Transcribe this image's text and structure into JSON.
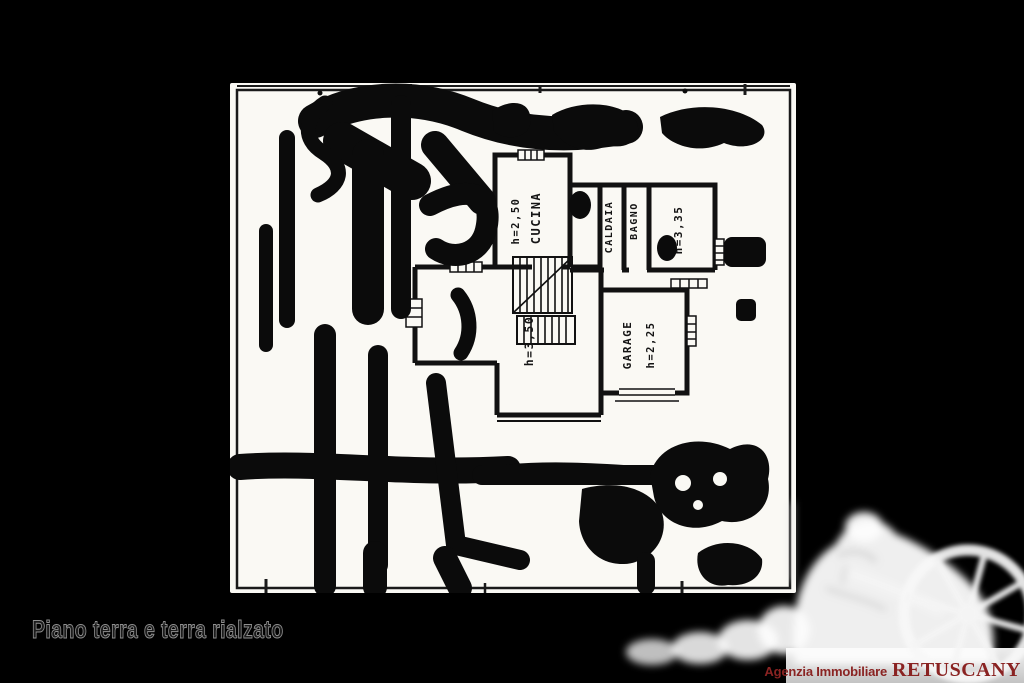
{
  "page": {
    "background": "#000000",
    "width": 1024,
    "height": 683
  },
  "caption": {
    "text": "Piano terra e terra rialzato",
    "color": "#1b1b1b"
  },
  "plan": {
    "colors": {
      "sheet": "#faf9f4",
      "ink": "#0b0b0b"
    },
    "rooms": {
      "cucina": {
        "name": "CUCINA",
        "height": "h=2,50"
      },
      "caldaia": {
        "name": "CALDAIA"
      },
      "bagno": {
        "name": "BAGNO"
      },
      "room_h335": {
        "height": "h=3,35"
      },
      "room_h350": {
        "height": "h=3,50"
      },
      "garage": {
        "name": "GARAGE",
        "height": "h=2,25"
      }
    }
  },
  "agency": {
    "prefix": "Agenzia Immobiliare",
    "brand": "RETUSCANY",
    "text_color": "#8a2322",
    "strip_color": "#d9d9d9"
  },
  "watermark": {
    "icon": "statue-with-wheel-watermark"
  }
}
